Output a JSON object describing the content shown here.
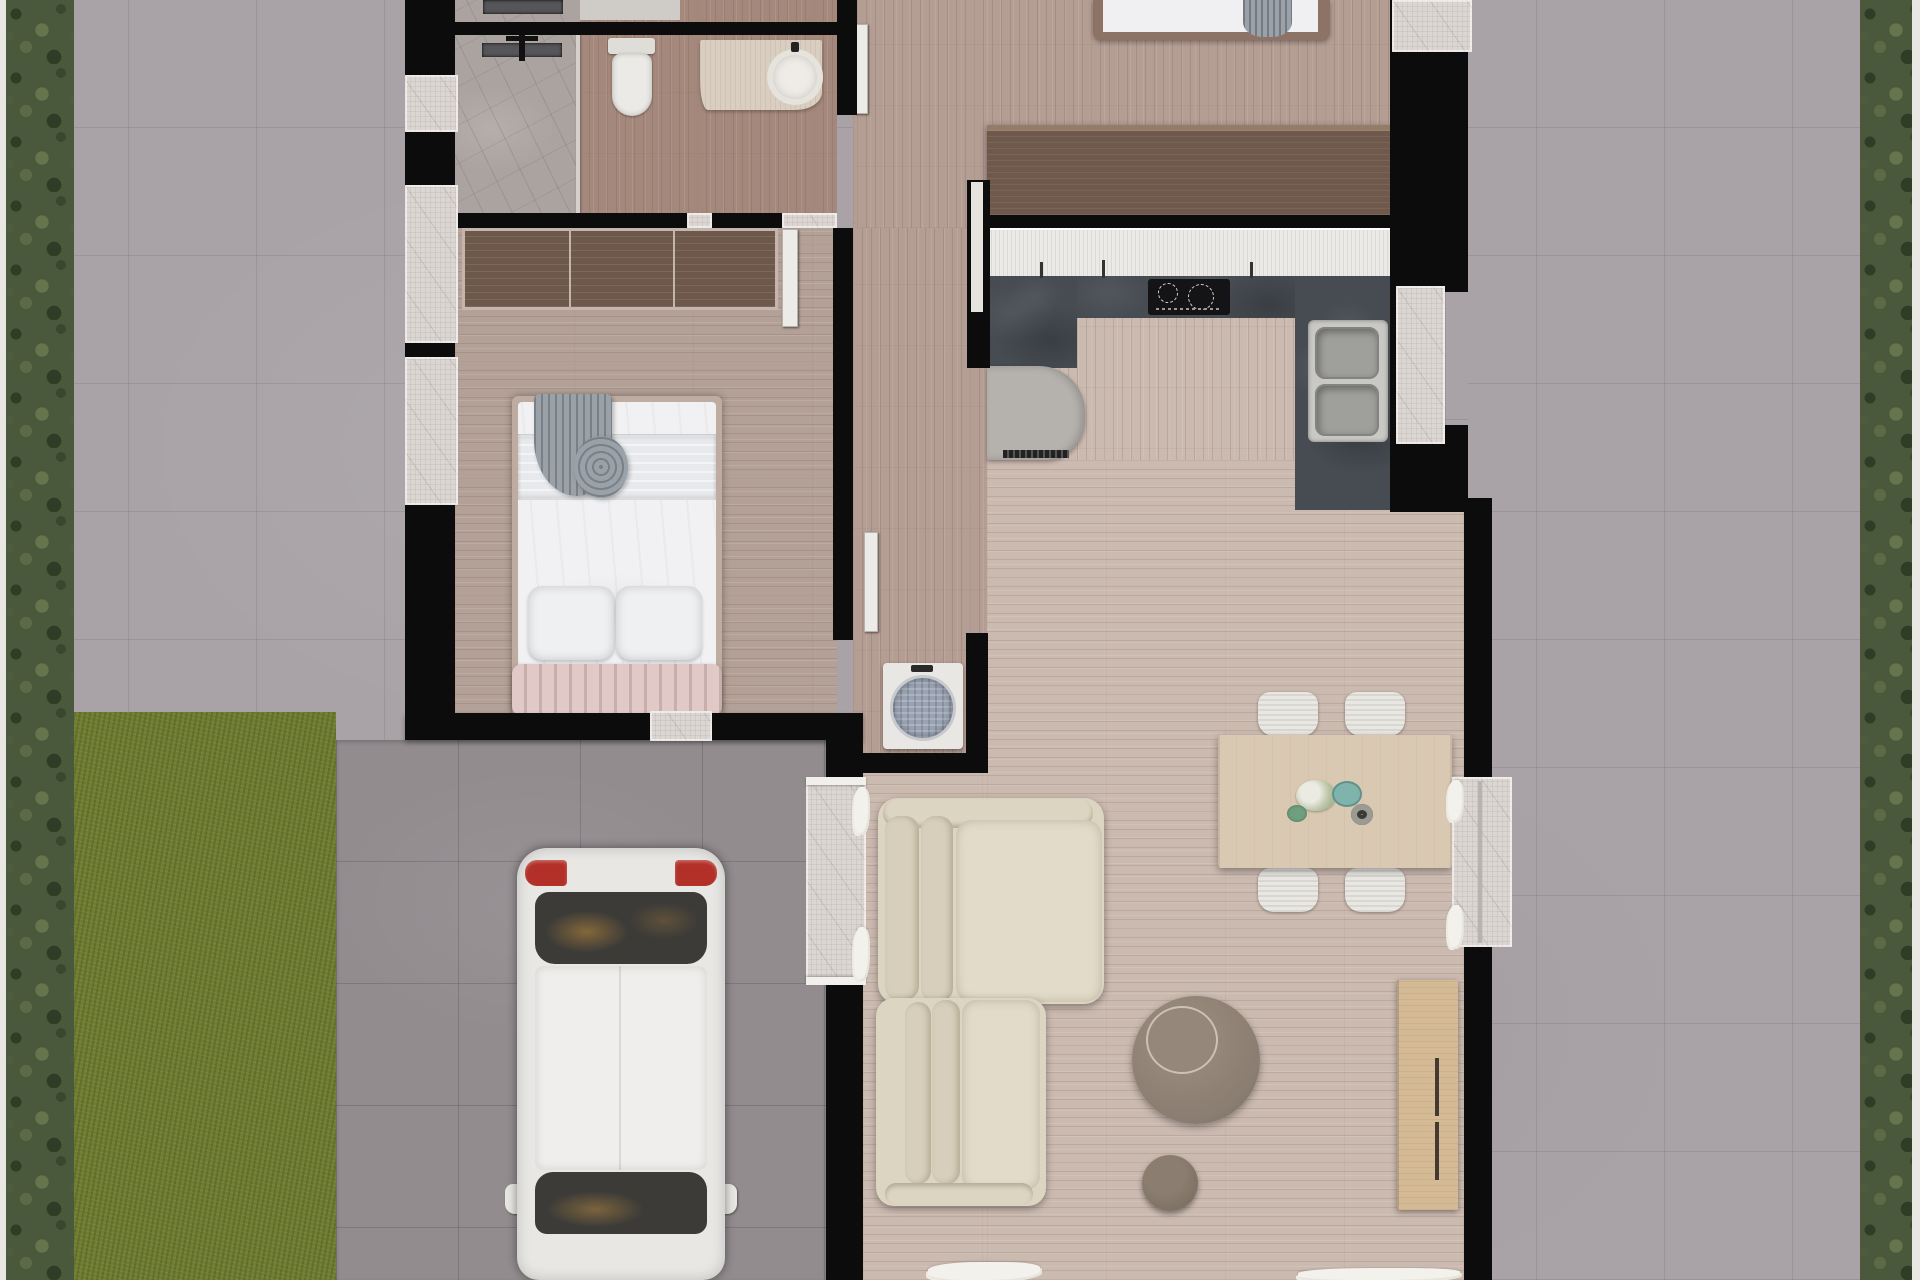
{
  "scene": {
    "type": "architectural-floor-plan-3d-render",
    "view": "top-down",
    "description": "Single-storey house plan render with grey paved yard, side hedges, lawn patch, driveway with white car, bathroom, two bedrooms, kitchen and open living-dining room"
  },
  "colors": {
    "paving": "#a9a3a7",
    "driveway": "#928c8f",
    "lawn": "#6e7d31",
    "hedge": "#4a583c",
    "hedge_dark": "#2f3d26",
    "hedge_light": "#66754e",
    "fence": "#e9e7e4",
    "wall": "#0c0c0c",
    "marble": "#dbd6d1",
    "marble_floor": "#aba39f",
    "wood_warm": "#b49d93",
    "wood_bath": "#a5887c",
    "wood_bed": "#b3a096",
    "wood_light": "#cbbab0",
    "wardrobe": "#6e584c",
    "wardrobe_frame": "#c4b6ac",
    "dresser": "#6f594c",
    "counter_white": "#eceae6",
    "counter_dark": "#474c52",
    "cooktop": "#141416",
    "steel": "#c9c8c4",
    "steel_deep": "#9fa09c",
    "fridge": "#b5b2ad",
    "cream": "#dcd5c2",
    "cream_light": "#e2dbc9",
    "chair": "#e9e7e2",
    "table_wood": "#d9c8b2",
    "oak": "#d5ba96",
    "taupe": "#8a7d71",
    "taupe_dark": "#7d7164",
    "pink": "#e0c9c6",
    "pink_deep": "#c9aeab",
    "duvet": "#f1f1f3",
    "gray_throw": "#9aa1a8",
    "car_body": "#e8e7e4",
    "glass": "#3c3b38",
    "taillight": "#b23028",
    "drum": "#9aa3b2",
    "teal": "#7fb3ac",
    "sage": "#6f9f7f"
  },
  "outdoor": {
    "items": [
      "left-fence",
      "left-hedge",
      "right-fence",
      "right-hedge",
      "paved-yard",
      "lawn-patch",
      "driveway",
      "white-car"
    ],
    "car": {
      "parts": [
        "rear-bumper",
        "left-taillight",
        "right-taillight",
        "rear-window",
        "roof",
        "windshield",
        "side-mirrors",
        "hood"
      ]
    }
  },
  "rooms": [
    {
      "name": "bathroom",
      "floor": "marble-and-wood",
      "items": [
        "towel-radiator",
        "shower-area",
        "glass-screen",
        "toilet",
        "vanity-counter",
        "round-basin"
      ]
    },
    {
      "name": "bedroom-left",
      "floor": "wood",
      "items": [
        "sliding-wardrobe",
        "double-bed",
        "grey-throw",
        "two-pillows",
        "pink-channel-headboard",
        "window"
      ]
    },
    {
      "name": "bedroom-top-right",
      "floor": "wood",
      "items": [
        "double-bed",
        "grey-blanket",
        "long-dresser",
        "window"
      ]
    },
    {
      "name": "kitchen",
      "floor": "wood",
      "items": [
        "white-worktop",
        "dark-quartz-l-counter",
        "induction-hob",
        "double-sink",
        "fridge",
        "window"
      ]
    },
    {
      "name": "hallway",
      "floor": "wood",
      "items": [
        "washing-machine",
        "open-door",
        "interior-doors"
      ]
    },
    {
      "name": "living-dining",
      "floor": "wood",
      "items": [
        "dining-table",
        "four-ribbed-chairs",
        "table-centerpiece",
        "l-shaped-sofa",
        "two-seat-sofa",
        "round-coffee-table",
        "pouf",
        "tv-sideboard",
        "entry-porch",
        "east-window",
        "white-rugs"
      ]
    }
  ]
}
